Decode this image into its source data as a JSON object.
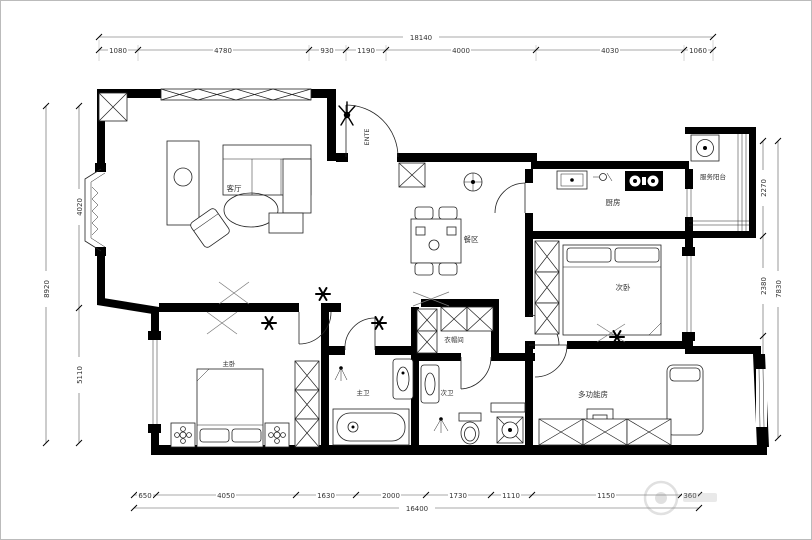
{
  "rooms": {
    "living": "客厅",
    "dining": "餐区",
    "kitchen": "厨房",
    "service_balcony": "服务阳台",
    "bedroom_second": "次卧",
    "multi_function": "多功能房",
    "master_bedroom": "主卧",
    "master_bath": "主卫",
    "second_bath": "次卫",
    "cloakroom": "衣帽间",
    "entry": "ENTE"
  },
  "dims": {
    "top": {
      "total": "18140",
      "segments": [
        "1080",
        "4780",
        "930",
        "1190",
        "4000",
        "4030",
        "1060"
      ]
    },
    "bottom": {
      "total": "16400",
      "segments": [
        "650",
        "4050",
        "1630",
        "2000",
        "1730",
        "1110",
        "1150",
        "360"
      ]
    },
    "left": {
      "total": "8920",
      "segments": [
        "4020",
        "5110"
      ]
    },
    "right": {
      "total": "7830",
      "segments": [
        "2270",
        "2380",
        "2780"
      ]
    }
  },
  "colors": {
    "wall": "#000000",
    "line": "#555555",
    "background": "#ffffff"
  }
}
